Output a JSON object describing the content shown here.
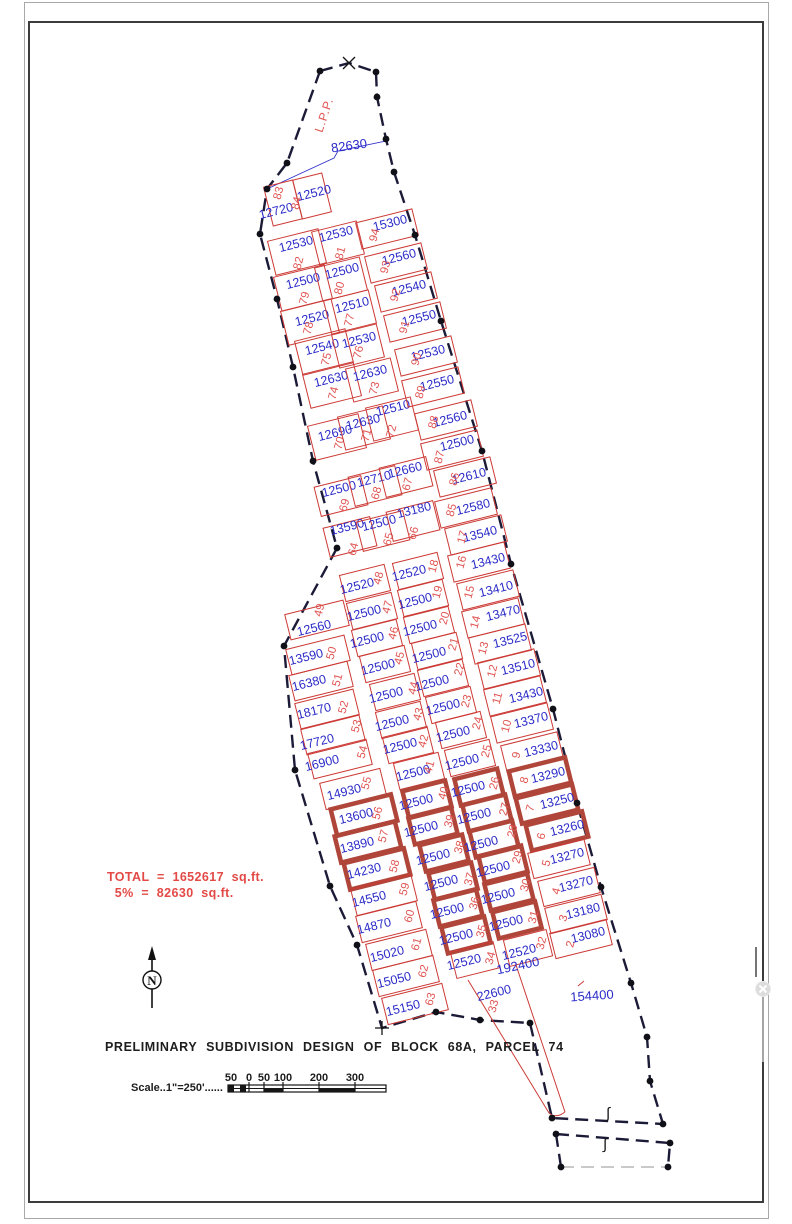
{
  "title": "PRELIMINARY SUBDIVISION DESIGN OF BLOCK 68A, PARCEL 74",
  "annotations": {
    "total_line1": "TOTAL  =  1652617  sq.ft.",
    "total_line2": "  5%  =  82630  sq.ft."
  },
  "scale": {
    "label": "Scale..1\"=250'......",
    "ticks": [
      {
        "t": "50",
        "x": 231
      },
      {
        "t": "0",
        "x": 249
      },
      {
        "t": "50",
        "x": 264
      },
      {
        "t": "100",
        "x": 283
      },
      {
        "t": "200",
        "x": 319
      },
      {
        "t": "300",
        "x": 355
      }
    ]
  },
  "drawing": {
    "lpp_label": "L.P.P.",
    "top_dim_label": "82630",
    "north_label": "N",
    "stream_marks": [
      {
        "glyph": "∫",
        "x": 608,
        "y": 1118
      },
      {
        "glyph": "∫",
        "x": 605,
        "y": 1149
      }
    ],
    "colors": {
      "lot_line": "#cc3a35",
      "lot_bold": "#b0453a",
      "area_text": "#2a2ac8",
      "lot_number_text": "#e05552",
      "boundary": "#1b1b38",
      "total_text": "#e34a46"
    }
  },
  "large_parcels": [
    {
      "label": "192400",
      "x": 518,
      "y": 966,
      "rot": -12
    },
    {
      "label": "154400",
      "x": 592,
      "y": 996,
      "rot": -4
    }
  ],
  "lot_groups": {
    "tl": {
      "w": 30,
      "h": 40
    },
    "a": {
      "w": 52,
      "h": 35
    },
    "b": {
      "w": 46,
      "h": 34
    },
    "c": {
      "w": 48,
      "h": 30
    },
    "r": {
      "w": 58,
      "h": 27
    },
    "lm": {
      "w": 60,
      "h": 26
    },
    "lb": {
      "w": 62,
      "h": 27
    },
    "m1": {
      "w": 46,
      "h": 27
    },
    "m2": {
      "w": 46,
      "h": 27
    },
    "bm1": {
      "w": 44,
      "h": 27
    },
    "bm2": {
      "w": 44,
      "h": 27
    },
    "br": {
      "w": 58,
      "h": 26
    },
    "none": null
  },
  "lots_schema": "[lot_no, area_sqft, rect_cx, rect_cy, area_label_x, area_label_y, number_label_x, number_label_y, group, bold]",
  "lots": [
    [
      "83",
      "12720",
      283,
      203,
      276,
      211,
      278,
      193,
      "tl",
      0
    ],
    [
      "84",
      "12520",
      312,
      196,
      314,
      193,
      296,
      203,
      "tl",
      0
    ],
    [
      "82",
      "12530",
      297,
      252,
      296,
      244,
      298,
      263,
      "a",
      0
    ],
    [
      "79",
      "12500",
      303,
      288,
      303,
      281,
      304,
      298,
      "a",
      0
    ],
    [
      "78",
      "12520",
      310,
      322,
      312,
      318,
      308,
      328,
      "a",
      0
    ],
    [
      "75",
      "12540",
      324,
      352,
      322,
      347,
      326,
      359,
      "a",
      0
    ],
    [
      "74",
      "12630",
      332,
      385,
      331,
      379,
      333,
      393,
      "a",
      0
    ],
    [
      "70",
      "12690",
      337,
      437,
      335,
      433,
      339,
      443,
      "a",
      0
    ],
    [
      "81",
      "12530",
      338,
      243,
      336,
      234,
      340,
      253,
      "b",
      0
    ],
    [
      "80",
      "12500",
      341,
      279,
      342,
      271,
      339,
      288,
      "b",
      0
    ],
    [
      "77",
      "12510",
      350,
      312,
      352,
      305,
      349,
      320,
      "b",
      0
    ],
    [
      "76",
      "12530",
      358,
      346,
      359,
      340,
      358,
      352,
      "b",
      0
    ],
    [
      "73",
      "12630",
      372,
      380,
      370,
      373,
      374,
      388,
      "b",
      0
    ],
    [
      "71",
      "12630",
      364,
      428,
      363,
      422,
      366,
      435,
      "b",
      0
    ],
    [
      "72",
      "12510",
      392,
      419,
      393,
      408,
      391,
      431,
      "b",
      0
    ],
    [
      "69",
      "12500",
      341,
      496,
      339,
      489,
      344,
      505,
      "c",
      0
    ],
    [
      "68",
      "12710",
      375,
      486,
      374,
      479,
      376,
      493,
      "c",
      0
    ],
    [
      "67",
      "12660",
      406,
      477,
      405,
      470,
      407,
      484,
      "c",
      0
    ],
    [
      "64",
      "13590",
      350,
      537,
      347,
      527,
      353,
      549,
      "c",
      0
    ],
    [
      "65",
      "12500",
      383,
      531,
      379,
      523,
      388,
      539,
      "c",
      0
    ],
    [
      "66",
      "13180",
      413,
      521,
      414,
      510,
      413,
      533,
      "c",
      0
    ],
    [
      "94",
      "15300",
      387,
      229,
      390,
      223,
      374,
      235,
      "r",
      0
    ],
    [
      "93",
      "12560",
      396,
      263,
      399,
      257,
      385,
      267,
      "r",
      0
    ],
    [
      "92",
      "12540",
      406,
      292,
      409,
      288,
      395,
      295,
      "r",
      0
    ],
    [
      "91",
      "12550",
      415,
      322,
      419,
      318,
      404,
      327,
      "r",
      0
    ],
    [
      "90",
      "12530",
      426,
      356,
      428,
      353,
      416,
      359,
      "r",
      0
    ],
    [
      "89",
      "12550",
      433,
      387,
      437,
      383,
      420,
      392,
      "r",
      0
    ],
    [
      "88",
      "12560",
      446,
      420,
      450,
      419,
      433,
      422,
      "r",
      0
    ],
    [
      "87",
      "12500",
      452,
      450,
      457,
      443,
      439,
      457,
      "r",
      0
    ],
    [
      "86",
      "12610",
      465,
      477,
      469,
      476,
      454,
      479,
      "r",
      0
    ],
    [
      "85",
      "12580",
      466,
      508,
      473,
      507,
      451,
      510,
      "r",
      0
    ],
    [
      "17",
      "13540",
      476,
      535,
      480,
      534,
      462,
      537,
      "r",
      0
    ],
    [
      "16",
      "13430",
      479,
      562,
      488,
      561,
      461,
      562,
      "r",
      0
    ],
    [
      "15",
      "13410",
      488,
      590,
      496,
      589,
      469,
      592,
      "r",
      0
    ],
    [
      "14",
      "13470",
      493,
      618,
      503,
      613,
      475,
      622,
      "r",
      0
    ],
    [
      "13",
      "13525",
      500,
      644,
      510,
      640,
      483,
      648,
      "r",
      0
    ],
    [
      "12",
      "13510",
      509,
      669,
      518,
      667,
      492,
      671,
      "r",
      0
    ],
    [
      "11",
      "13430",
      515,
      696,
      526,
      695,
      497,
      698,
      "r",
      0
    ],
    [
      "10",
      "13370",
      522,
      723,
      531,
      720,
      506,
      726,
      "r",
      0
    ],
    [
      "9",
      "13330",
      532,
      752,
      541,
      749,
      516,
      755,
      "r",
      0
    ],
    [
      "49",
      "12560",
      317,
      620,
      314,
      628,
      319,
      610,
      "lm",
      0
    ],
    [
      "50",
      "13590",
      318,
      655,
      306,
      657,
      331,
      653,
      "lm",
      0
    ],
    [
      "51",
      "16380",
      321,
      681,
      309,
      683,
      337,
      680,
      "lm",
      0
    ],
    [
      "52",
      "18170",
      327,
      709,
      314,
      711,
      343,
      707,
      "lm",
      0
    ],
    [
      "53",
      "17720",
      333,
      735,
      317,
      742,
      356,
      726,
      "lm",
      0
    ],
    [
      "54",
      "16900",
      340,
      759,
      322,
      763,
      362,
      752,
      "lm",
      0
    ],
    [
      "55",
      "14930",
      353,
      789,
      344,
      792,
      366,
      783,
      "lb",
      0
    ],
    [
      "56",
      "13600",
      364,
      815,
      356,
      816,
      377,
      813,
      "lb",
      1
    ],
    [
      "57",
      "13890",
      368,
      842,
      357,
      845,
      383,
      836,
      "lb",
      1
    ],
    [
      "58",
      "14230",
      377,
      869,
      364,
      871,
      394,
      866,
      "lb",
      1
    ],
    [
      "59",
      "14550",
      384,
      895,
      369,
      899,
      404,
      889,
      "lb",
      0
    ],
    [
      "60",
      "14870",
      389,
      922,
      374,
      926,
      409,
      916,
      "lb",
      0
    ],
    [
      "61",
      "15020",
      399,
      950,
      387,
      954,
      416,
      944,
      "lb",
      0
    ],
    [
      "62",
      "15050",
      406,
      976,
      394,
      980,
      423,
      971,
      "lb",
      0
    ],
    [
      "63",
      "15150",
      415,
      1004,
      403,
      1008,
      430,
      999,
      "lb",
      0
    ],
    [
      "48",
      "12520",
      365,
      583,
      357,
      586,
      378,
      578,
      "m1",
      0
    ],
    [
      "47",
      "12500",
      372,
      611,
      364,
      613,
      387,
      607,
      "m1",
      0
    ],
    [
      "46",
      "12500",
      377,
      638,
      367,
      640,
      393,
      633,
      "m1",
      0
    ],
    [
      "45",
      "12500",
      385,
      664,
      378,
      667,
      399,
      658,
      "m1",
      0
    ],
    [
      "44",
      "12500",
      395,
      692,
      386,
      695,
      413,
      688,
      "m1",
      0
    ],
    [
      "43",
      "12500",
      401,
      720,
      392,
      723,
      418,
      714,
      "m1",
      0
    ],
    [
      "42",
      "12500",
      408,
      745,
      400,
      746,
      423,
      741,
      "m1",
      0
    ],
    [
      "41",
      "12500",
      419,
      771,
      413,
      773,
      429,
      767,
      "m1",
      0
    ],
    [
      "18",
      "12520",
      418,
      571,
      409,
      573,
      433,
      566,
      "m2",
      0
    ],
    [
      "19",
      "12500",
      423,
      598,
      415,
      601,
      437,
      592,
      "m2",
      0
    ],
    [
      "20",
      "12500",
      429,
      625,
      420,
      628,
      444,
      618,
      "m2",
      0
    ],
    [
      "21",
      "12500",
      437,
      651,
      429,
      655,
      453,
      644,
      "m2",
      0
    ],
    [
      "22",
      "12500",
      443,
      678,
      432,
      683,
      459,
      669,
      "m2",
      0
    ],
    [
      "23",
      "12500",
      451,
      705,
      443,
      707,
      466,
      701,
      "m2",
      0
    ],
    [
      "24",
      "12500",
      461,
      730,
      453,
      734,
      477,
      723,
      "m2",
      0
    ],
    [
      "25",
      "12500",
      470,
      758,
      462,
      762,
      486,
      751,
      "m2",
      0
    ],
    [
      "40",
      "12500",
      427,
      799,
      416,
      802,
      443,
      793,
      "bm1",
      1
    ],
    [
      "39",
      "12500",
      433,
      826,
      421,
      829,
      449,
      821,
      "bm1",
      1
    ],
    [
      "38",
      "12500",
      444,
      853,
      433,
      857,
      459,
      847,
      "bm1",
      1
    ],
    [
      "37",
      "12500",
      453,
      881,
      441,
      883,
      469,
      879,
      "bm1",
      1
    ],
    [
      "36",
      "12500",
      458,
      908,
      447,
      911,
      474,
      903,
      "bm1",
      1
    ],
    [
      "35",
      "12500",
      466,
      935,
      456,
      937,
      481,
      931,
      "bm1",
      1
    ],
    [
      "34",
      "12520",
      475,
      960,
      464,
      962,
      490,
      958,
      "bm1",
      0
    ],
    [
      "26",
      "12500",
      479,
      787,
      468,
      789,
      494,
      783,
      "bm2",
      1
    ],
    [
      "27",
      "12500",
      487,
      813,
      474,
      816,
      504,
      809,
      "bm2",
      1
    ],
    [
      "28",
      "12500",
      494,
      839,
      481,
      844,
      512,
      831,
      "bm2",
      1
    ],
    [
      "29",
      "12500",
      503,
      864,
      493,
      869,
      517,
      857,
      "bm2",
      1
    ],
    [
      "30",
      "12500",
      509,
      892,
      498,
      896,
      525,
      885,
      "bm2",
      1
    ],
    [
      "31",
      "12500",
      517,
      920,
      506,
      923,
      533,
      917,
      "bm2",
      1
    ],
    [
      "32",
      "12520",
      528,
      948,
      519,
      952,
      541,
      943,
      "bm2",
      0
    ],
    [
      "8",
      "13290",
      540,
      777,
      548,
      775,
      524,
      780,
      "br",
      1
    ],
    [
      "7",
      "13250",
      547,
      804,
      557,
      801,
      530,
      808,
      "br",
      1
    ],
    [
      "6",
      "13260",
      557,
      831,
      567,
      828,
      541,
      836,
      "br",
      1
    ],
    [
      "5",
      "13270",
      559,
      859,
      567,
      856,
      546,
      863,
      "br",
      0
    ],
    [
      "4",
      "13270",
      569,
      887,
      576,
      884,
      556,
      891,
      "br",
      0
    ],
    [
      "3",
      "13180",
      576,
      914,
      583,
      911,
      563,
      918,
      "br",
      0
    ],
    [
      "2",
      "13080",
      581,
      939,
      588,
      935,
      570,
      944,
      "br",
      0
    ],
    [
      "33",
      "22600",
      0,
      0,
      494,
      993,
      493,
      1006,
      "none",
      0
    ]
  ],
  "survey_points": [
    [
      320,
      71
    ],
    [
      376,
      72
    ],
    [
      377,
      97
    ],
    [
      386,
      139
    ],
    [
      394,
      172
    ],
    [
      415,
      235
    ],
    [
      441,
      321
    ],
    [
      482,
      451
    ],
    [
      511,
      564
    ],
    [
      553,
      709
    ],
    [
      577,
      803
    ],
    [
      601,
      887
    ],
    [
      631,
      983
    ],
    [
      647,
      1037
    ],
    [
      650,
      1081
    ],
    [
      663,
      1124
    ],
    [
      287,
      163
    ],
    [
      267,
      189
    ],
    [
      260,
      234
    ],
    [
      277,
      299
    ],
    [
      293,
      367
    ],
    [
      313,
      461
    ],
    [
      337,
      548
    ],
    [
      284,
      646
    ],
    [
      295,
      770
    ],
    [
      330,
      886
    ],
    [
      357,
      945
    ],
    [
      436,
      1012
    ],
    [
      480,
      1020
    ],
    [
      530,
      1023
    ],
    [
      552,
      1118
    ],
    [
      556,
      1134
    ],
    [
      670,
      1143
    ],
    [
      561,
      1167
    ],
    [
      668,
      1167
    ]
  ]
}
